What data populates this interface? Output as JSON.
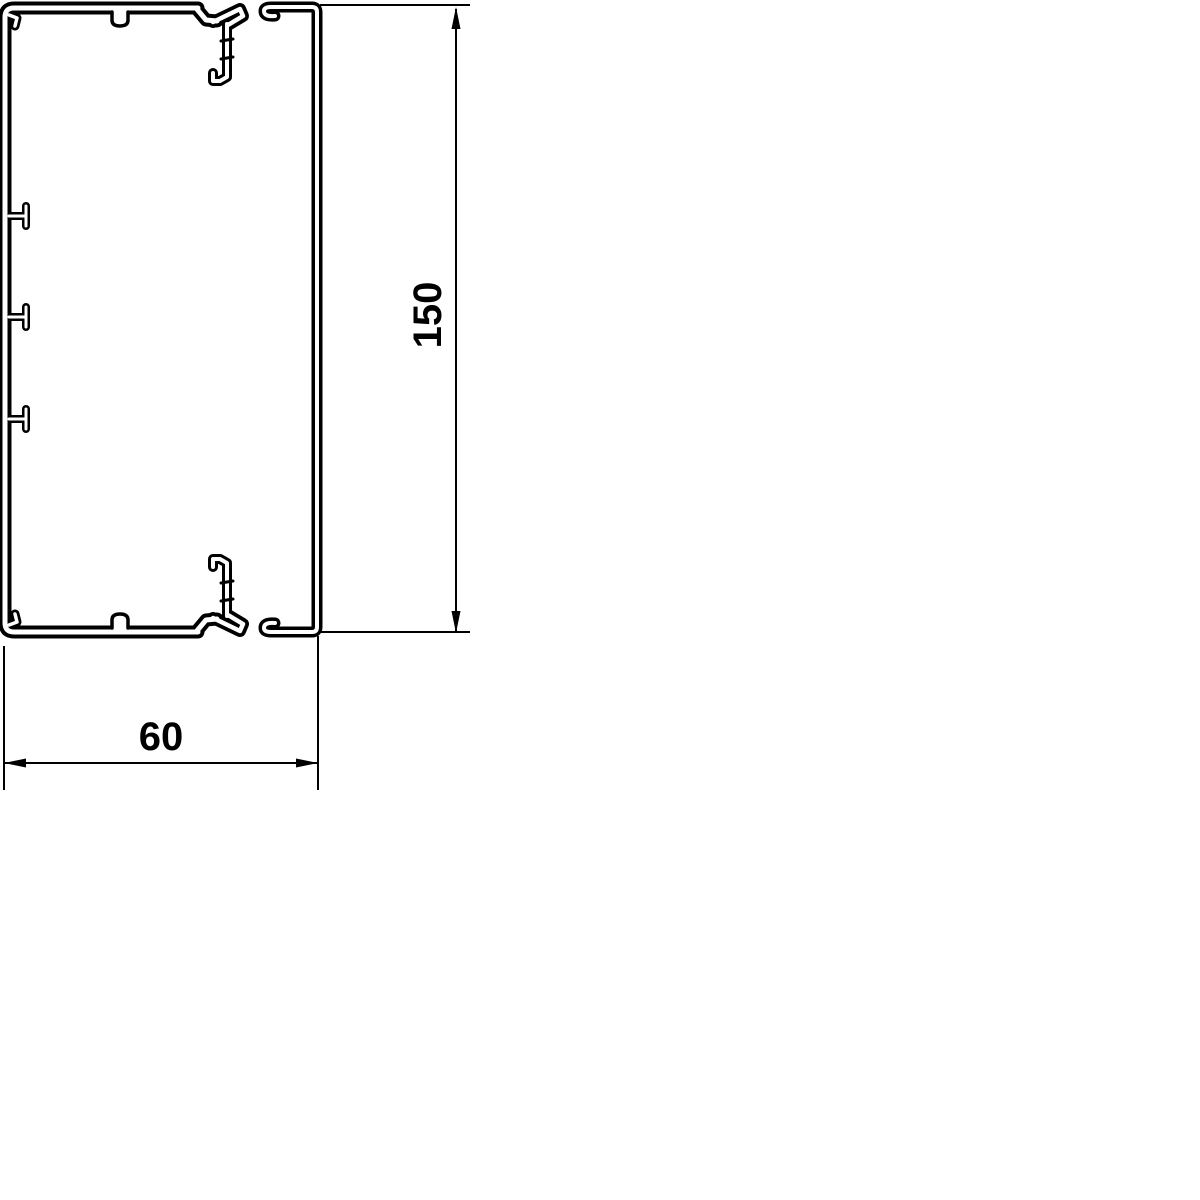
{
  "canvas": {
    "background_color": "#ffffff",
    "line_color": "#000000"
  },
  "drawing": {
    "type": "technical-cross-section",
    "dimensions": {
      "height": {
        "label": "150"
      },
      "width": {
        "label": "60"
      }
    }
  }
}
